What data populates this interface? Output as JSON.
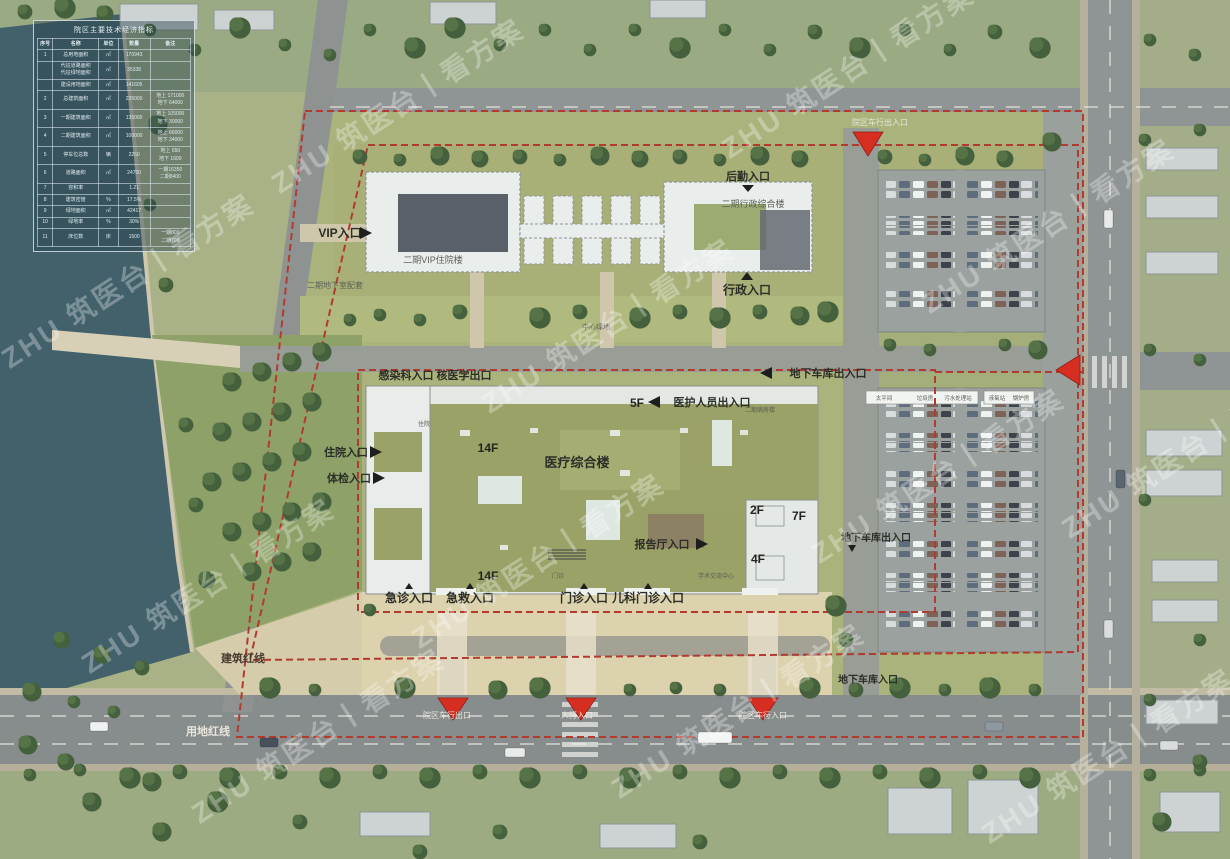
{
  "watermark": {
    "text": "ZHU 筑医台丨看方案"
  },
  "table": {
    "title": "院区主要技术经济指标",
    "headers": [
      "序号",
      "名称",
      "单位",
      "数量",
      "备注"
    ],
    "rows": [
      {
        "no": "1",
        "name": "总用地面积",
        "unit": "㎡",
        "qty": "170943",
        "note": ""
      },
      {
        "no": "",
        "name": "代征道路面积\n代征绿地面积",
        "unit": "㎡",
        "qty": "35338",
        "note": ""
      },
      {
        "no": "",
        "name": "建设用地面积",
        "unit": "㎡",
        "qty": "141605",
        "note": ""
      },
      {
        "no": "2",
        "name": "总建筑面积",
        "unit": "㎡",
        "qty": "235000",
        "note": "地上 171000\n地下 64000"
      },
      {
        "no": "3",
        "name": "一期建筑面积",
        "unit": "㎡",
        "qty": "135000",
        "note": "地上 105000\n地下 30000"
      },
      {
        "no": "4",
        "name": "二期建筑面积",
        "unit": "㎡",
        "qty": "100000",
        "note": "地上 66000\n地下 34000"
      },
      {
        "no": "5",
        "name": "停车位总数",
        "unit": "辆",
        "qty": "2250",
        "note": "地上 650\n地下 1600"
      },
      {
        "no": "6",
        "name": "道路面积",
        "unit": "㎡",
        "qty": "24750",
        "note": "一期16350\n二期8400"
      },
      {
        "no": "7",
        "name": "容积率",
        "unit": "",
        "qty": "1.21",
        "note": ""
      },
      {
        "no": "8",
        "name": "建筑密度",
        "unit": "%",
        "qty": "17.5%",
        "note": ""
      },
      {
        "no": "9",
        "name": "绿地面积",
        "unit": "㎡",
        "qty": "42417",
        "note": ""
      },
      {
        "no": "10",
        "name": "绿地率",
        "unit": "%",
        "qty": "30%",
        "note": ""
      },
      {
        "no": "11",
        "name": "床位数",
        "unit": "床",
        "qty": "1500",
        "note": "一期800\n二期700"
      }
    ]
  },
  "labels": {
    "vip_entrance": "VIP入口",
    "logistics_entrance": "后勤入口",
    "admin_entrance": "行政入口",
    "vip_building": "二期VIP住院楼",
    "admin_building": "二期行政综合楼",
    "phase2_basement": "二期地下室配套",
    "central_green": "中心绿地",
    "infection_entrance": "感染科入口  核医学出口",
    "staff_entrance": "医护人员出入口",
    "phase2_ward": "二期病房楼",
    "inpatient_entrance": "住院入口",
    "checkup_entrance": "体检入口",
    "medical_complex": "医疗综合楼",
    "inpatient_small": "住院",
    "outpatient_small": "门诊",
    "academic_center": "学术交流中心",
    "lecture_entrance": "报告厅入口",
    "garage_exit_east": "地下车库出入口",
    "garage_exit_mid": "地下车库出入口",
    "garage_entrance_south": "地下车库入口",
    "emergency_entrance": "急诊入口",
    "firstaid_entrance": "急救入口",
    "outpatient_entrance": "门诊入口",
    "pediatric_entrance": "儿科门诊入口",
    "building_redline": "建筑红线",
    "land_redline": "用地红线",
    "campus_vehicle_exit": "院区车行出口",
    "pedestrian_entrance": "人行入口",
    "campus_vehicle_entrance": "院区车行入口",
    "street_gate": "院区车行出入口",
    "morgue": "太平间",
    "garbage": "垃圾房",
    "sewage": "污水处理站",
    "oxygen": "液氧站",
    "boiler": "锅炉房"
  },
  "floors": {
    "f5": "5F",
    "f14_mid": "14F",
    "f14_south": "14F",
    "f2": "2F",
    "f7": "7F",
    "f4": "4F"
  },
  "colors": {
    "redline": "#b23b2f",
    "marker": "#d62e20",
    "roof_olive": "#9aa267",
    "lake": "#42616b"
  }
}
